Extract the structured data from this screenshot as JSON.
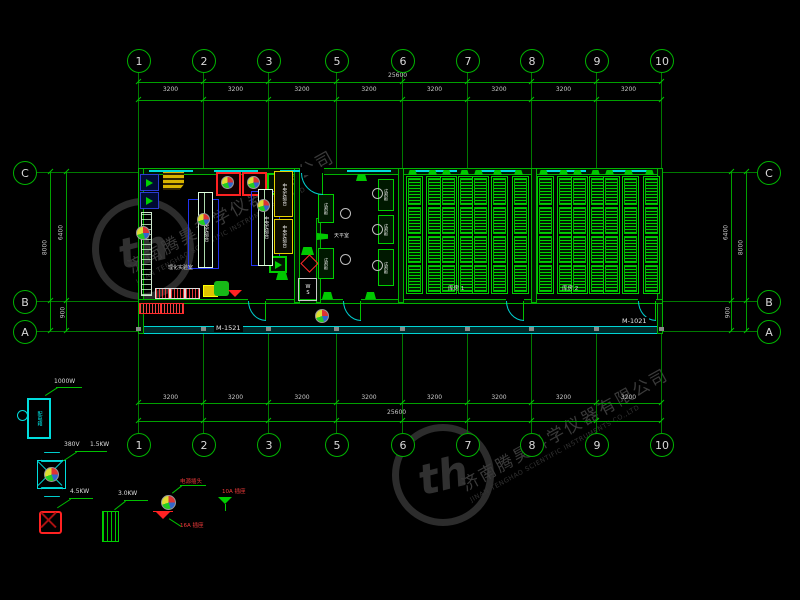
{
  "watermark": {
    "company_cn": "济南腾昊科学仪器有限公司",
    "company_en": "JINAN TENGHAO SCIENTIFIC INSTRUMENTS CO.,LTD",
    "logo_monogram": "th"
  },
  "grid": {
    "column_labels": [
      "1",
      "2",
      "3",
      "5",
      "6",
      "7",
      "8",
      "9",
      "10"
    ],
    "column_bay_dim": "3200",
    "column_total_dim": "25600",
    "row_labels": [
      "C",
      "B",
      "A"
    ],
    "row_dim_c_b": "6400",
    "row_dim_b_a": "900",
    "row_dim_total": "8000"
  },
  "plan": {
    "room_labels": [
      "理化实验室",
      "天平室",
      "库房 1",
      "库房 2"
    ],
    "bench_label": "中央实验台",
    "cabinet_label": "试剂柜",
    "shaft_label": "WS",
    "door_marks": [
      "M-1521",
      "M-1021"
    ]
  },
  "legend": {
    "panel_label": "配电箱",
    "panel_power": "1000W",
    "transformer_voltage": "380V",
    "transformer_power": "1.5KW",
    "socket_power": "4.5KW",
    "heater_power": "3.0KW",
    "plug_label": "电源插头",
    "socket16_label": "16A 插座",
    "socket10_label": "10A 插座"
  },
  "colors": {
    "line_green": "#00b300",
    "cyan": "#00e5e5",
    "yellow": "#e6d400",
    "red": "#ff2a2a",
    "blue": "#2233ee",
    "dim_text": "#c8c8c8",
    "watermark": "#343434"
  }
}
